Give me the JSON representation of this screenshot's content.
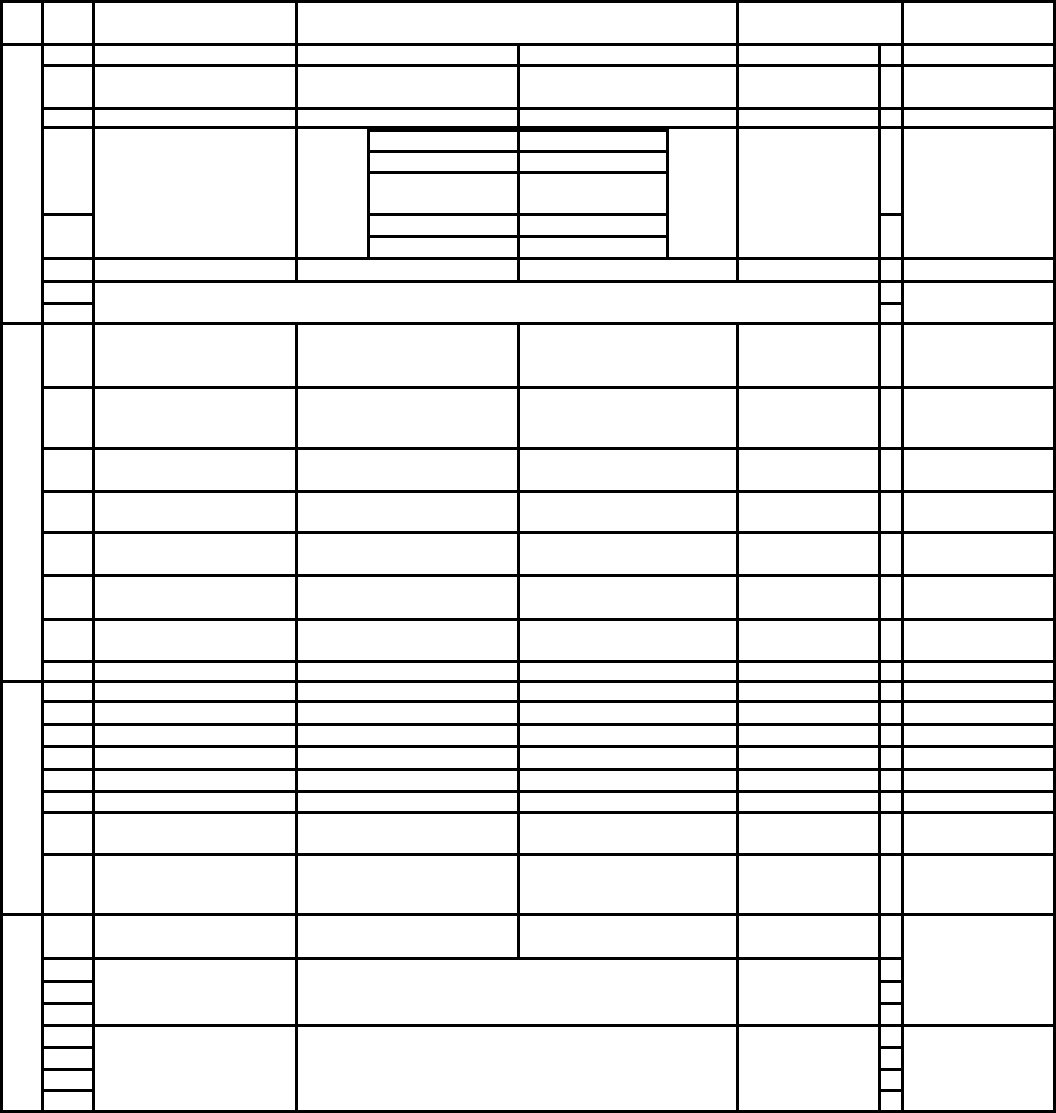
{
  "document": {
    "description": "Blank form table with empty cells, nested sub-table and narrow tick column; no visible text",
    "canvas": {
      "width": 1056,
      "height": 1113
    },
    "background_color": "#ffffff",
    "line_color": "#000000",
    "line_thickness": 3
  },
  "grid": {
    "verticals": [
      [
        0,
        0,
        1110
      ],
      [
        41,
        0,
        1110
      ],
      [
        92,
        0,
        1110
      ],
      [
        295,
        0,
        280
      ],
      [
        295,
        322,
        1110
      ],
      [
        367,
        129,
        257
      ],
      [
        517,
        43,
        280
      ],
      [
        517,
        322,
        957
      ],
      [
        666,
        129,
        257
      ],
      [
        736,
        0,
        280
      ],
      [
        736,
        322,
        1110
      ],
      [
        878,
        43,
        1110
      ],
      [
        901,
        0,
        1110
      ],
      [
        1053,
        0,
        1110
      ]
    ],
    "horizontals": [
      [
        0,
        0,
        1053
      ],
      [
        43,
        0,
        1053
      ],
      [
        64,
        41,
        1053
      ],
      [
        107,
        41,
        1053
      ],
      [
        126,
        41,
        1053
      ],
      [
        129,
        367,
        666
      ],
      [
        150,
        367,
        666
      ],
      [
        171,
        367,
        666
      ],
      [
        213,
        367,
        666
      ],
      [
        213,
        41,
        92
      ],
      [
        213,
        878,
        901
      ],
      [
        235,
        367,
        666
      ],
      [
        257,
        41,
        1053
      ],
      [
        280,
        41,
        1053
      ],
      [
        302,
        41,
        92
      ],
      [
        302,
        878,
        901
      ],
      [
        322,
        0,
        1053
      ],
      [
        386,
        41,
        1053
      ],
      [
        447,
        41,
        1053
      ],
      [
        490,
        41,
        1053
      ],
      [
        531,
        41,
        1053
      ],
      [
        574,
        41,
        1053
      ],
      [
        618,
        41,
        1053
      ],
      [
        660,
        41,
        1053
      ],
      [
        680,
        0,
        1053
      ],
      [
        700,
        41,
        1053
      ],
      [
        723,
        41,
        1053
      ],
      [
        745,
        41,
        1053
      ],
      [
        768,
        41,
        1053
      ],
      [
        790,
        41,
        1053
      ],
      [
        811,
        41,
        1053
      ],
      [
        853,
        41,
        1053
      ],
      [
        913,
        0,
        1053
      ],
      [
        957,
        41,
        901
      ],
      [
        980,
        41,
        92
      ],
      [
        980,
        878,
        901
      ],
      [
        1002,
        41,
        92
      ],
      [
        1002,
        878,
        901
      ],
      [
        1024,
        41,
        1053
      ],
      [
        1046,
        41,
        92
      ],
      [
        1046,
        878,
        901
      ],
      [
        1068,
        41,
        92
      ],
      [
        1068,
        878,
        901
      ],
      [
        1089,
        41,
        92
      ],
      [
        1089,
        878,
        901
      ],
      [
        1110,
        0,
        1053
      ]
    ]
  },
  "regions": [
    {
      "name": "header-row",
      "x": 0,
      "y": 0,
      "w": 1053,
      "h": 43
    },
    {
      "name": "section-1",
      "x": 0,
      "y": 43,
      "w": 1053,
      "h": 279
    },
    {
      "name": "nested-sub-table",
      "x": 367,
      "y": 129,
      "w": 299,
      "h": 128
    },
    {
      "name": "section-2",
      "x": 0,
      "y": 322,
      "w": 1053,
      "h": 358
    },
    {
      "name": "section-3",
      "x": 0,
      "y": 680,
      "w": 1053,
      "h": 233
    },
    {
      "name": "section-4",
      "x": 0,
      "y": 913,
      "w": 1053,
      "h": 197
    },
    {
      "name": "left-label-column",
      "x": 0,
      "y": 43,
      "w": 41,
      "h": 1067
    },
    {
      "name": "row-number-column",
      "x": 41,
      "y": 43,
      "w": 51,
      "h": 1067
    },
    {
      "name": "narrow-tick-column",
      "x": 878,
      "y": 43,
      "w": 23,
      "h": 1067
    },
    {
      "name": "right-remarks-column",
      "x": 901,
      "y": 0,
      "w": 152,
      "h": 1110
    }
  ]
}
